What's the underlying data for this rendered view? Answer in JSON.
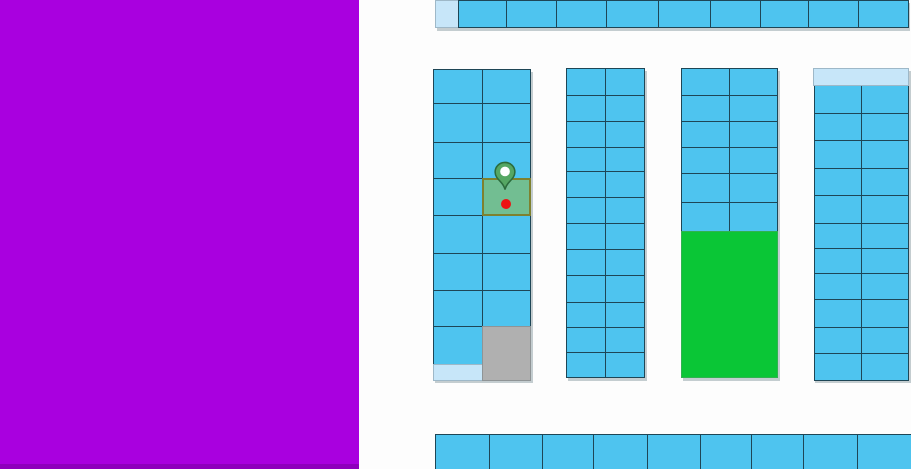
{
  "canvas": {
    "width": 911,
    "height": 469,
    "background": "#FDFDFD"
  },
  "left_panel": {
    "color": "#A900DF",
    "bottom_edge_color": "#8E00BC"
  },
  "palette": {
    "plot_fill": "#4EC4EF",
    "plot_border": "#1E4656",
    "reserved_light": "#C7E6F9",
    "occupied_gray": "#B0B0B0",
    "featured_green": "#0AC636",
    "highlight_fill": "#72BE92",
    "highlight_border": "#7E812F",
    "pin_fill": "#55A763",
    "pin_border": "#2B6C3C",
    "pin_dot": "#FFFFFF",
    "dot_color": "#EC1212",
    "shadow": "rgba(150,165,172,0.55)"
  },
  "map": {
    "shadows": [
      {
        "x": 435,
        "y": 0,
        "w": 473,
        "h": 28
      },
      {
        "x": 433,
        "y": 69,
        "w": 98,
        "h": 311
      },
      {
        "x": 566,
        "y": 68,
        "w": 79,
        "h": 310
      },
      {
        "x": 681,
        "y": 68,
        "w": 97,
        "h": 310
      },
      {
        "x": 813,
        "y": 68,
        "w": 96,
        "h": 312
      }
    ],
    "rows": {
      "top": {
        "y0": 0,
        "y1": 27,
        "light_first": true,
        "xs": [
          435,
          458,
          506,
          556,
          606,
          658,
          710,
          760,
          808,
          858,
          908
        ]
      },
      "bottom": {
        "y0": 434,
        "y1": 469,
        "light_first": false,
        "xs": [
          435,
          489,
          542,
          593,
          647,
          700,
          751,
          803,
          857,
          911
        ]
      }
    },
    "blocks": [
      {
        "name": "block-a",
        "columns": [
          {
            "x0": 433,
            "x1": 482,
            "ys": [
              69,
              103,
              142,
              178,
              215,
              253,
              290,
              326,
              364
            ]
          },
          {
            "x0": 482,
            "x1": 530,
            "ys": [
              69,
              103,
              142,
              178,
              215,
              253,
              290,
              326
            ]
          }
        ],
        "extras": [
          {
            "x": 433,
            "y": 364,
            "w": 50,
            "h": 17,
            "type": "reserved_light"
          },
          {
            "x": 482,
            "y": 326,
            "w": 49,
            "h": 55,
            "type": "occupied_gray"
          }
        ]
      },
      {
        "name": "block-b",
        "columns": [
          {
            "x0": 566,
            "x1": 605,
            "ys": [
              68,
              95,
              121,
              147,
              171,
              197,
              223,
              249,
              275,
              302,
              327,
              352,
              377
            ]
          },
          {
            "x0": 605,
            "x1": 644,
            "ys": [
              68,
              95,
              121,
              147,
              171,
              197,
              223,
              249,
              275,
              302,
              327,
              352,
              377
            ]
          }
        ],
        "extras": []
      },
      {
        "name": "block-c",
        "columns": [
          {
            "x0": 681,
            "x1": 729,
            "ys": [
              68,
              95,
              121,
              147,
              173,
              202,
              231
            ]
          },
          {
            "x0": 729,
            "x1": 777,
            "ys": [
              68,
              95,
              121,
              147,
              173,
              202,
              231
            ]
          }
        ],
        "extras": [
          {
            "x": 681,
            "y": 231,
            "w": 97,
            "h": 147,
            "type": "featured_green"
          }
        ]
      },
      {
        "name": "block-d",
        "columns": [
          {
            "x0": 814,
            "x1": 861,
            "ys": [
              85,
              113,
              140,
              168,
              195,
              223,
              248,
              273,
              299,
              327,
              353,
              380
            ]
          },
          {
            "x0": 861,
            "x1": 908,
            "ys": [
              85,
              113,
              140,
              168,
              195,
              223,
              248,
              273,
              299,
              327,
              353,
              380
            ]
          }
        ],
        "extras": [
          {
            "x": 813,
            "y": 68,
            "w": 96,
            "h": 18,
            "type": "reserved_light"
          }
        ]
      }
    ],
    "selection": {
      "highlight": {
        "x": 482,
        "y": 178,
        "w": 49,
        "h": 38
      },
      "pin": {
        "cx": 505,
        "top": 161,
        "width": 24,
        "height": 31
      },
      "dot": {
        "cx": 506,
        "cy": 204,
        "r": 5
      }
    }
  }
}
